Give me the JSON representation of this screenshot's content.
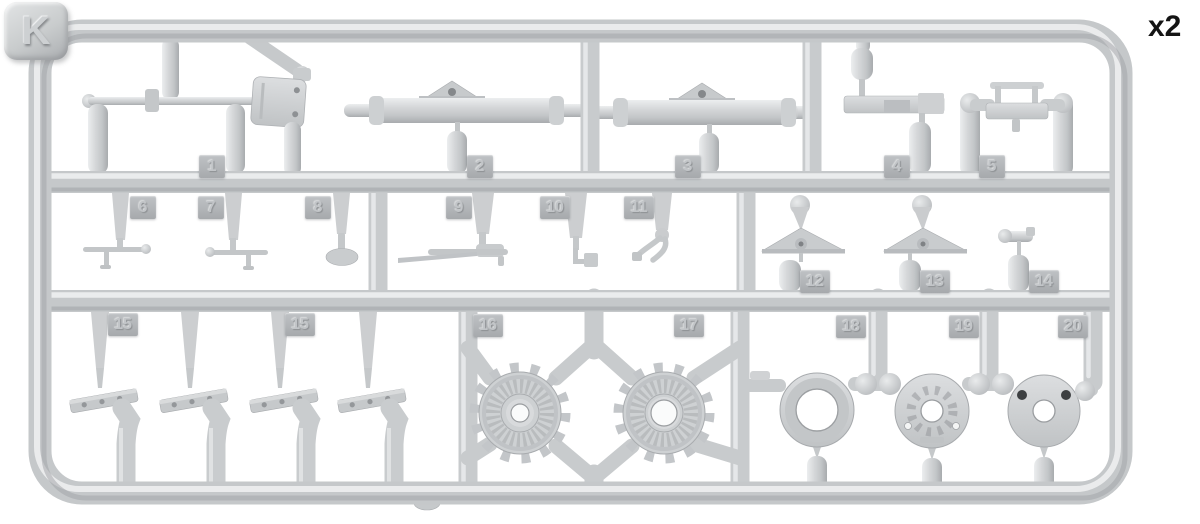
{
  "sprue": {
    "letter": "K",
    "quantity_label": "x2",
    "plastic_color": "#d2d4d6",
    "highlight_color": "#edeeef",
    "shadow_color": "#a6a9ac",
    "tag_color": "#b2b5b8",
    "background_color": "#ffffff",
    "tags": [
      "1",
      "2",
      "3",
      "4",
      "5",
      "6",
      "7",
      "8",
      "9",
      "10",
      "11",
      "12",
      "13",
      "14",
      "15",
      "15",
      "16",
      "17",
      "18",
      "19",
      "20"
    ],
    "parts": [
      {
        "number": "1",
        "shape": "shovel-with-rod",
        "count": 1
      },
      {
        "number": "2",
        "shape": "cylinder-with-triangular-bracket",
        "count": 1
      },
      {
        "number": "3",
        "shape": "cylinder-with-triangular-bracket",
        "count": 1
      },
      {
        "number": "4",
        "shape": "stepped-bracket-with-cylinders",
        "count": 1
      },
      {
        "number": "5",
        "shape": "rectangular-mount-frame",
        "count": 1
      },
      {
        "number": "6",
        "shape": "t-shaped-rod",
        "count": 1
      },
      {
        "number": "7",
        "shape": "t-shaped-rod",
        "count": 1
      },
      {
        "number": "8",
        "shape": "pin-with-round-pad",
        "count": 1
      },
      {
        "number": "9",
        "shape": "rod-with-handle",
        "count": 1
      },
      {
        "number": "10",
        "shape": "l-shaped-crank",
        "count": 1
      },
      {
        "number": "11",
        "shape": "forked-lever",
        "count": 1
      },
      {
        "number": "12",
        "shape": "triangular-mount-plate",
        "count": 1
      },
      {
        "number": "13",
        "shape": "triangular-mount-plate",
        "count": 1
      },
      {
        "number": "14",
        "shape": "elbow-pipe",
        "count": 1
      },
      {
        "number": "15",
        "shape": "hinge-bracket",
        "count": 4
      },
      {
        "number": "16",
        "shape": "drive-sprocket-wheel",
        "count": 1
      },
      {
        "number": "17",
        "shape": "drive-sprocket-wheel",
        "count": 1
      },
      {
        "number": "18",
        "shape": "ring",
        "count": 1
      },
      {
        "number": "19",
        "shape": "splined-hub-disc",
        "count": 1
      },
      {
        "number": "20",
        "shape": "disc-with-two-holes",
        "count": 1
      }
    ]
  }
}
